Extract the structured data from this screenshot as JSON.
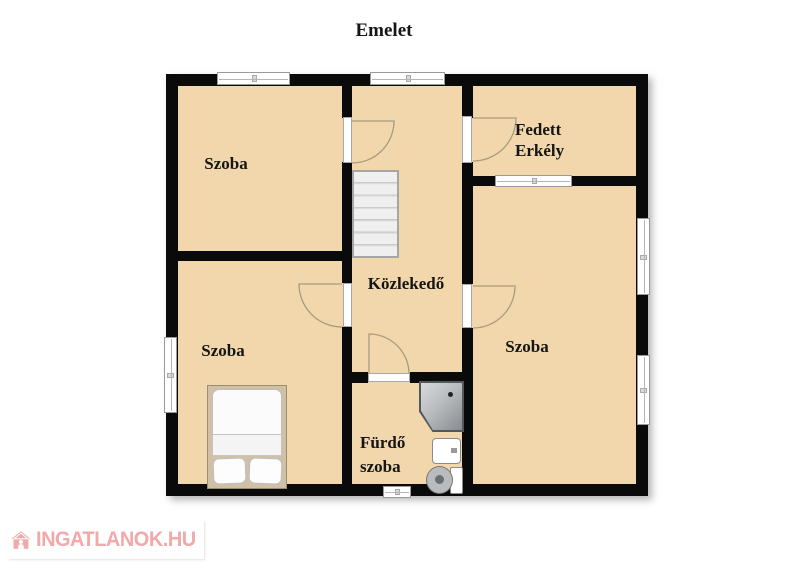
{
  "title": "Emelet",
  "rooms": {
    "top_left_bedroom": {
      "label": "Szoba"
    },
    "bottom_left_bedroom": {
      "label": "Szoba"
    },
    "right_bedroom": {
      "label": "Szoba"
    },
    "covered_balcony": {
      "line1": "Fedett",
      "line2": "Erkély"
    },
    "hallway": {
      "label": "Közlekedő"
    },
    "bathroom": {
      "line1": "Fürdő",
      "line2": "szoba"
    }
  },
  "furniture": {
    "staircase": "staircase",
    "double_bed": "double-bed",
    "corner_shower": "corner-shower",
    "sink": "sink",
    "toilet": "toilet"
  },
  "watermark": {
    "brand": "INGATLANOK.HU",
    "icon": "house-person-icon",
    "color": "#F2A9A9"
  },
  "colors": {
    "floor": "#F1D7AB",
    "wall": "#0A0A0A",
    "stairs": "#EFEFEF",
    "window": "#FFFFFF",
    "door_arc": "#A89B80"
  }
}
